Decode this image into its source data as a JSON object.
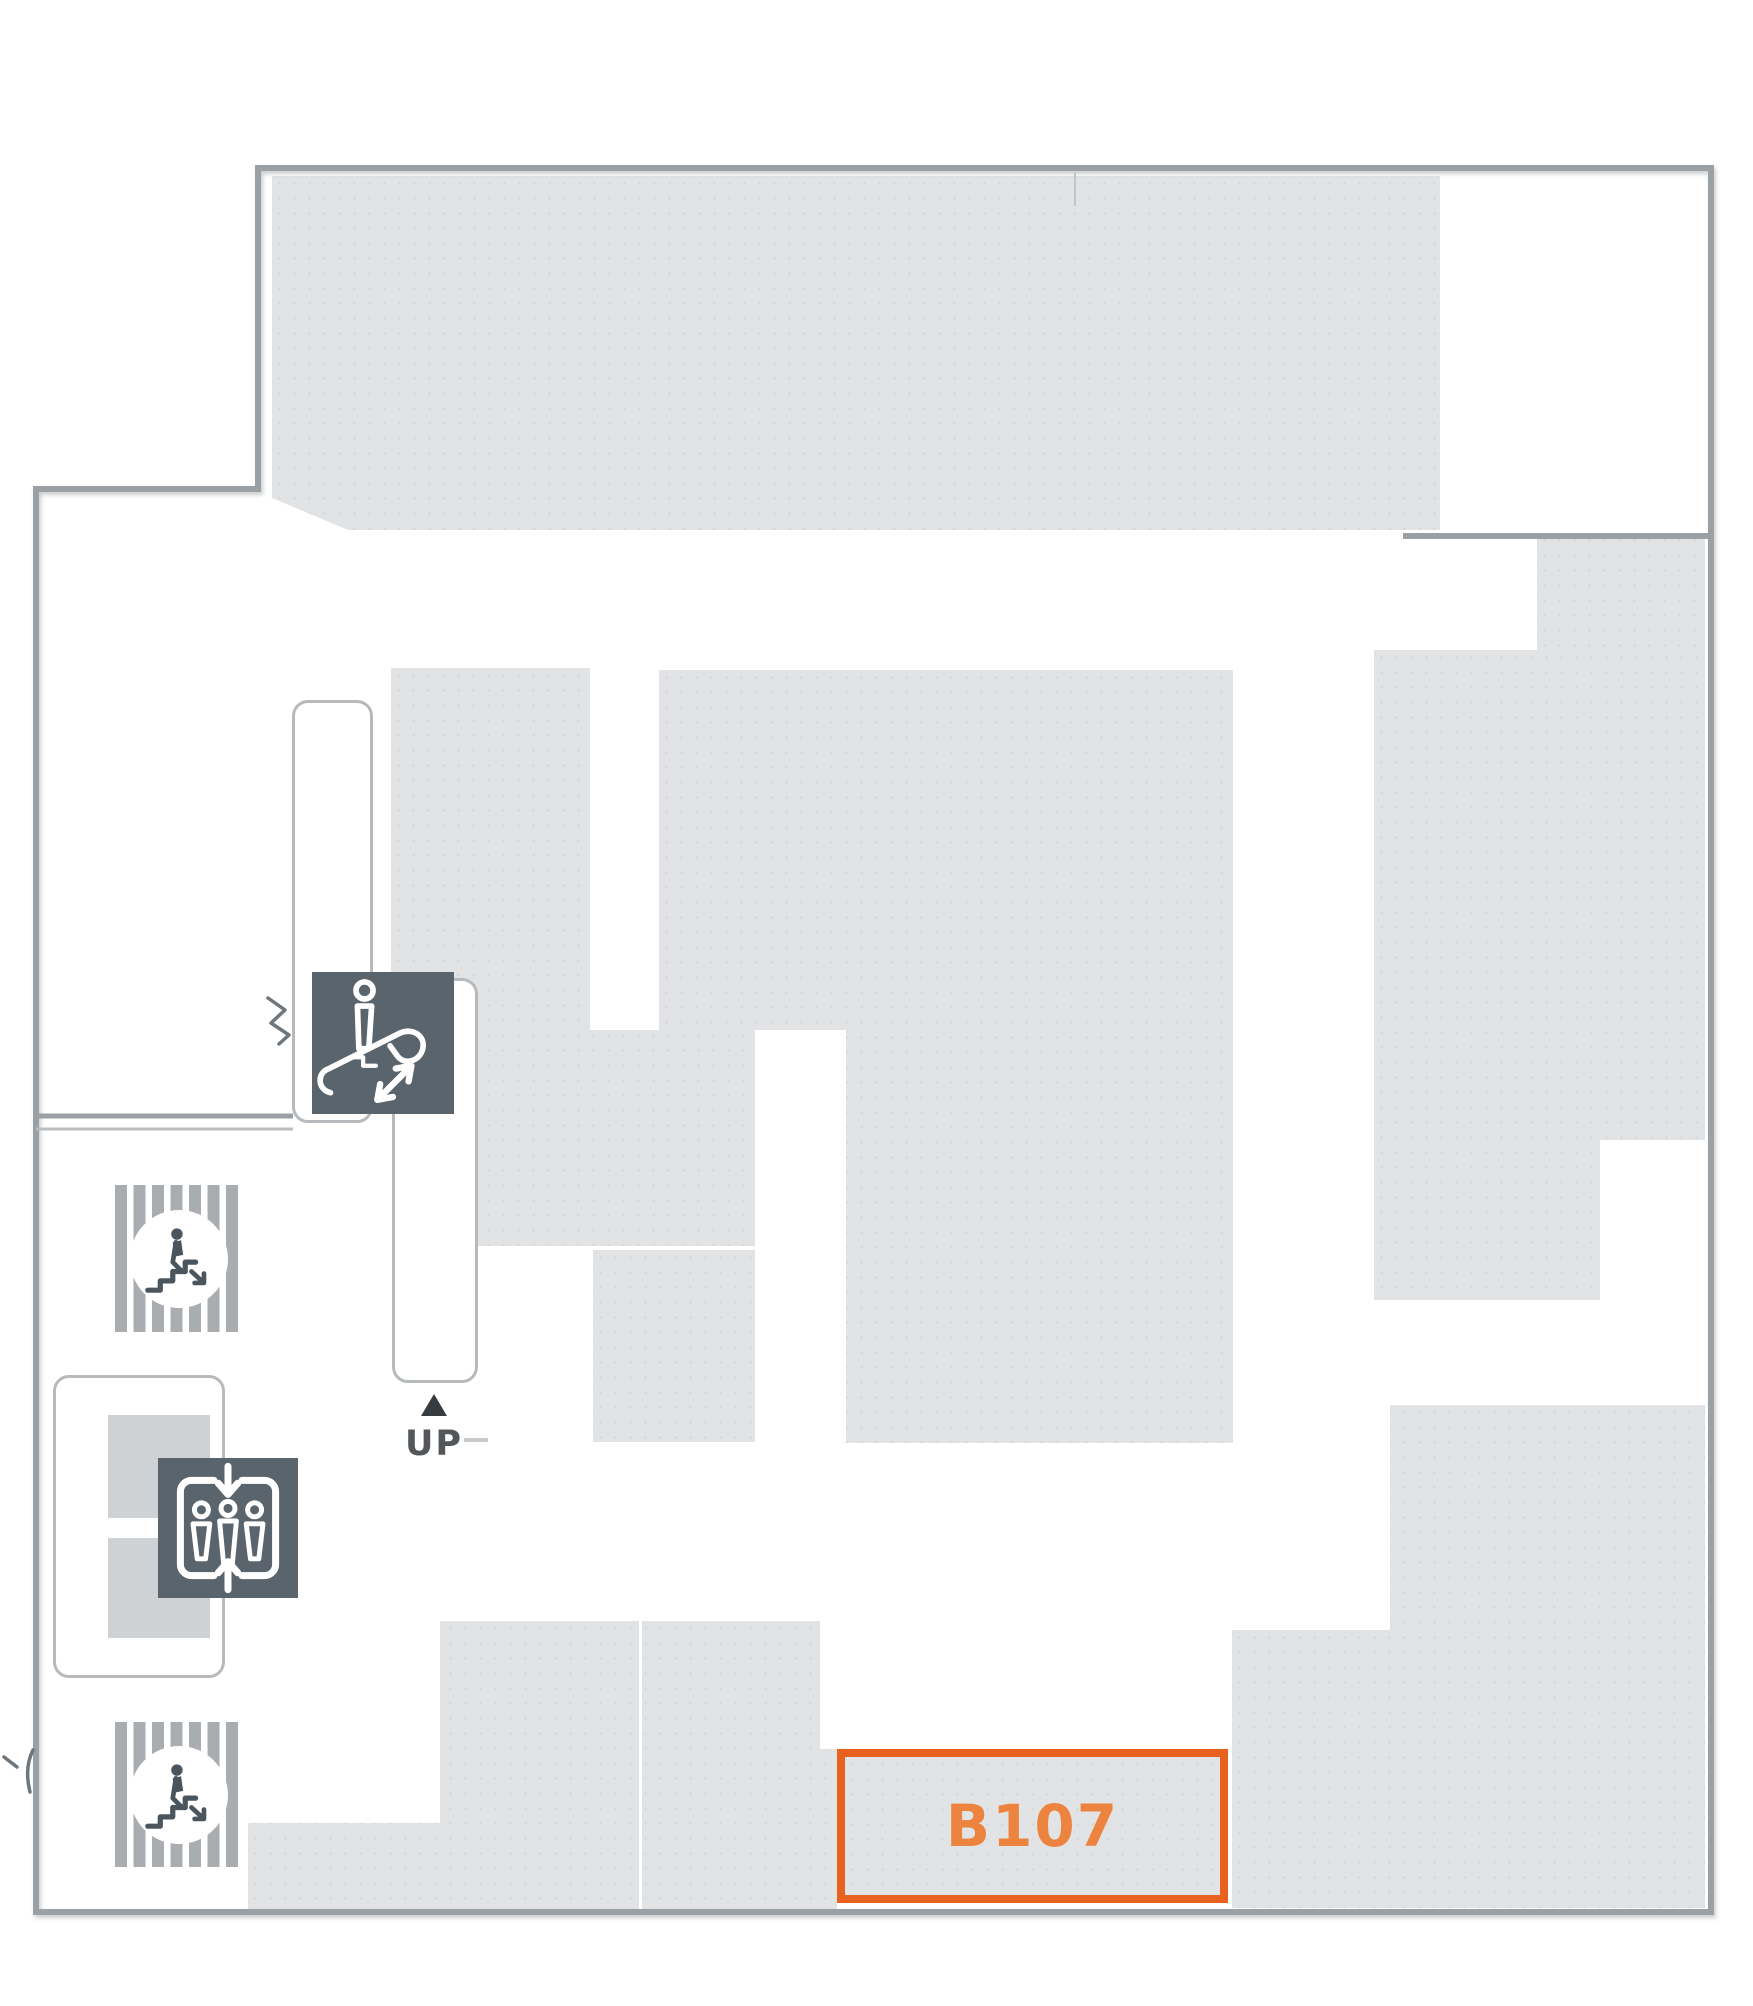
{
  "map": {
    "highlighted_room": {
      "id": "B107",
      "label": "B107"
    },
    "escalator": {
      "direction_label": "UP"
    },
    "legend": {
      "escalator_icon": "escalator",
      "elevator_icon": "elevator",
      "stairs_icon": "stairs"
    },
    "colors": {
      "highlight_border": "#E8611F",
      "highlight_text": "#EC8440",
      "icon_background": "#5A646D",
      "floor_fill": "#E2E3E4",
      "wall": "#9AA0A3",
      "shaft_outline": "#B6BABC",
      "icon_glyph": "#FFFFFF",
      "stairs_glyph": "#4B555E",
      "up_label": "#53575A"
    }
  }
}
